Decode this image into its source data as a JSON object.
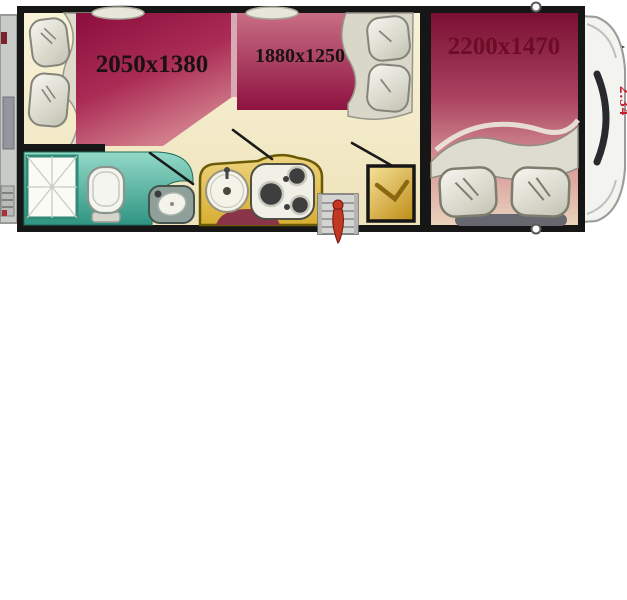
{
  "labels": {
    "overall_length": "6.62",
    "overall_height": "2.34",
    "rear_bed_size": "2050x1380",
    "dinette_bed_size": "1880x1250",
    "cab_bed_size": "2200x1470"
  },
  "colors": {
    "wall": "#161616",
    "floor_cream": "#f6efd2",
    "bed_maroon": "#8a0d3c",
    "bathroom_teal": "#2f9482",
    "kitchen_yellow": "#d8ae32",
    "cab_lavender": "#a9aacb",
    "dimension_text": "#151515",
    "height_label_red": "#c12130",
    "bed_label_dark_red": "#6d0c26"
  }
}
